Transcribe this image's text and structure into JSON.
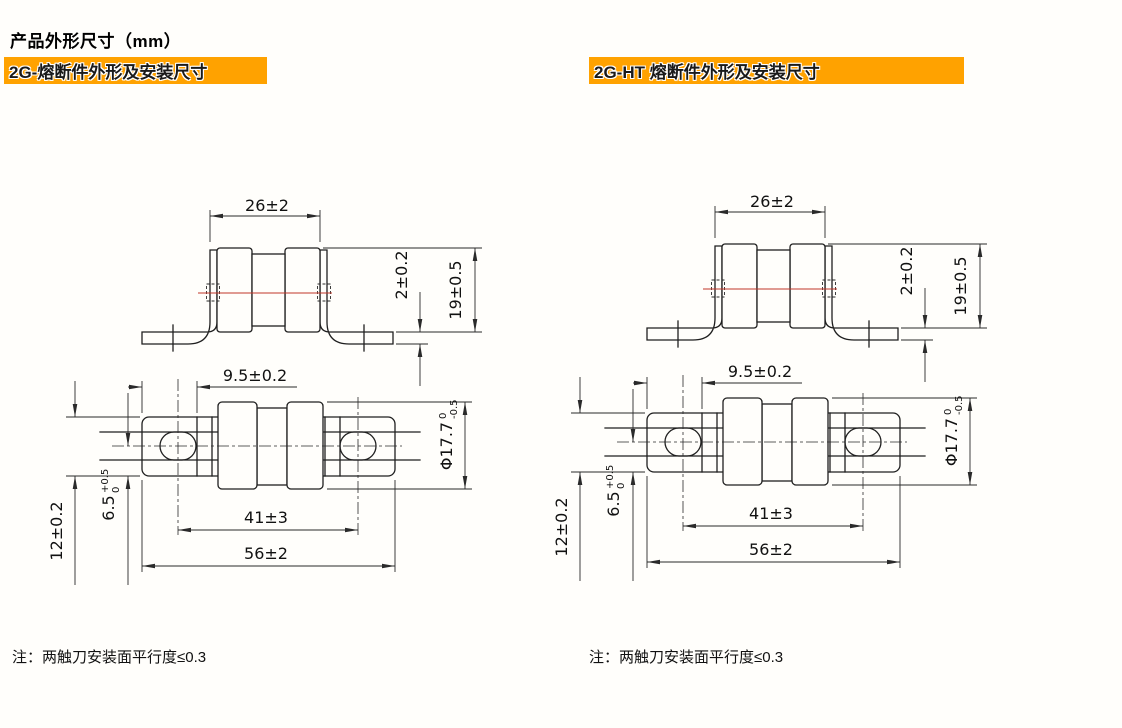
{
  "page": {
    "title": "产品外形尺寸（mm）",
    "accent_orange": "#FFA200",
    "centerline_red": "#C03528"
  },
  "panels": [
    {
      "header": "2G-熔断件外形及安装尺寸",
      "note": "注：两触刀安装面平行度≤0.3",
      "dims": {
        "body_width": "26±2",
        "blade_thickness": "2±0.2",
        "height": "19±0.5",
        "hole_edge_offset": "9.5±0.2",
        "diameter": "Φ17.7",
        "diameter_tol_upper": "0",
        "diameter_tol_lower": "-0.5",
        "hole_span": "41±3",
        "overall_length": "56±2",
        "blade_width": "12±0.2",
        "hole_center_offset": "6.5",
        "hole_center_tol_upper": "+0.5",
        "hole_center_tol_lower": "0"
      }
    },
    {
      "header": "2G-HT  熔断件外形及安装尺寸",
      "note": "注：两触刀安装面平行度≤0.3",
      "dims": {
        "body_width": "26±2",
        "blade_thickness": "2±0.2",
        "height": "19±0.5",
        "hole_edge_offset": "9.5±0.2",
        "diameter": "Φ17.7",
        "diameter_tol_upper": "0",
        "diameter_tol_lower": "-0.5",
        "hole_span": "41±3",
        "overall_length": "56±2",
        "blade_width": "12±0.2",
        "hole_center_offset": "6.5",
        "hole_center_tol_upper": "+0.5",
        "hole_center_tol_lower": "0"
      }
    }
  ]
}
